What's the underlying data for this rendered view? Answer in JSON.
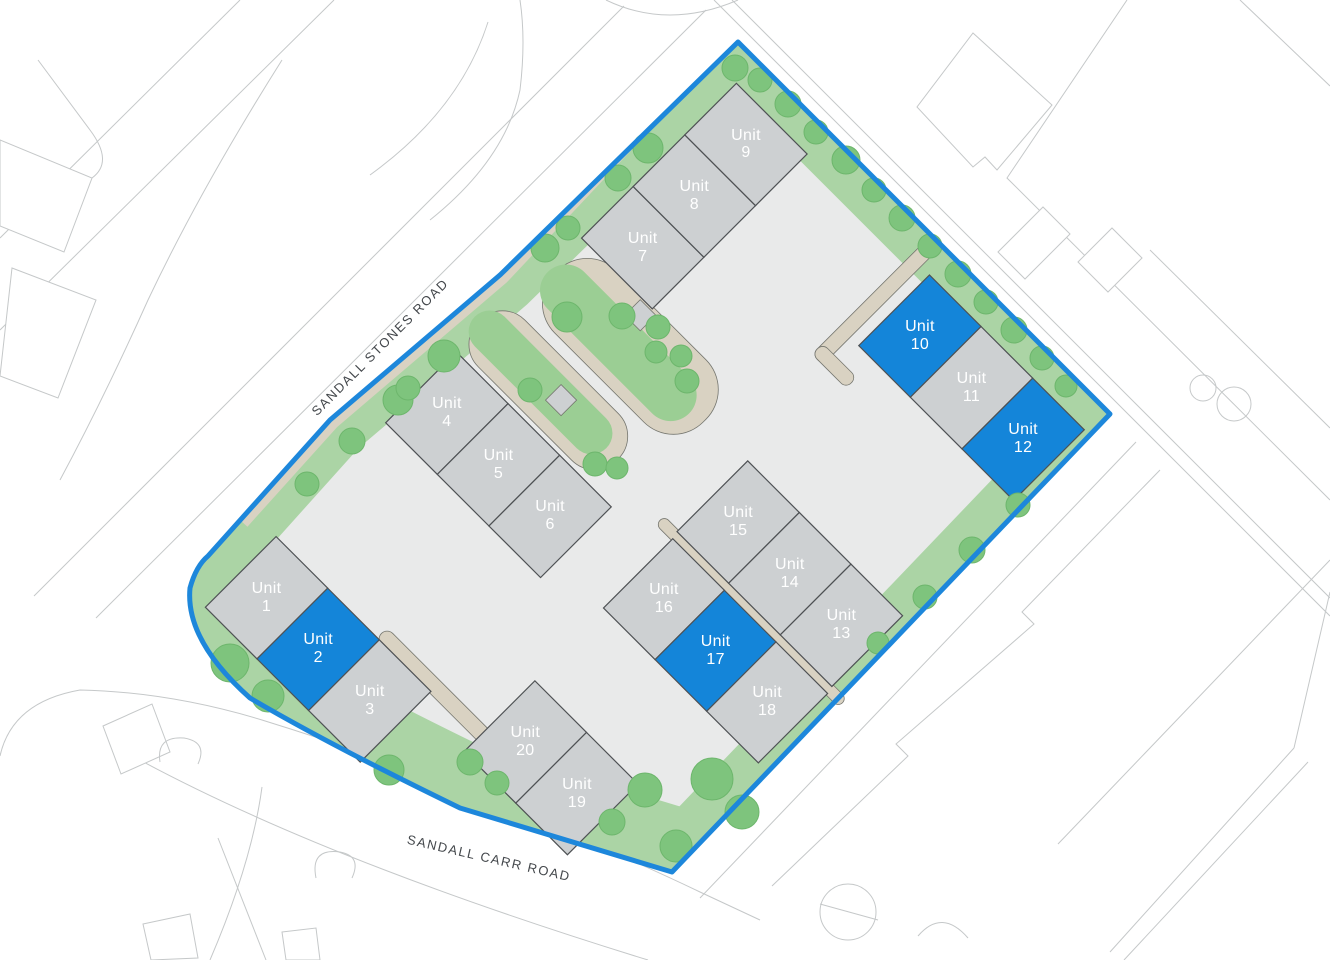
{
  "roads": {
    "sandall_stones": {
      "label": "SANDALL STONES ROAD"
    },
    "sandall_carr": {
      "label": "SANDALL CARR ROAD"
    }
  },
  "units": [
    {
      "number": "1",
      "label": "Unit",
      "highlighted": false
    },
    {
      "number": "2",
      "label": "Unit",
      "highlighted": true
    },
    {
      "number": "3",
      "label": "Unit",
      "highlighted": false
    },
    {
      "number": "4",
      "label": "Unit",
      "highlighted": false
    },
    {
      "number": "5",
      "label": "Unit",
      "highlighted": false
    },
    {
      "number": "6",
      "label": "Unit",
      "highlighted": false
    },
    {
      "number": "7",
      "label": "Unit",
      "highlighted": false
    },
    {
      "number": "8",
      "label": "Unit",
      "highlighted": false
    },
    {
      "number": "9",
      "label": "Unit",
      "highlighted": false
    },
    {
      "number": "10",
      "label": "Unit",
      "highlighted": true
    },
    {
      "number": "11",
      "label": "Unit",
      "highlighted": false
    },
    {
      "number": "12",
      "label": "Unit",
      "highlighted": true
    },
    {
      "number": "13",
      "label": "Unit",
      "highlighted": false
    },
    {
      "number": "14",
      "label": "Unit",
      "highlighted": false
    },
    {
      "number": "15",
      "label": "Unit",
      "highlighted": false
    },
    {
      "number": "16",
      "label": "Unit",
      "highlighted": false
    },
    {
      "number": "17",
      "label": "Unit",
      "highlighted": true
    },
    {
      "number": "18",
      "label": "Unit",
      "highlighted": false
    },
    {
      "number": "19",
      "label": "Unit",
      "highlighted": false
    },
    {
      "number": "20",
      "label": "Unit",
      "highlighted": false
    }
  ],
  "colors": {
    "highlighted_unit_blue": "#1485d9",
    "unit_grey": "#cdd0d2",
    "unit_outline": "#4e5154",
    "boundary_blue": "#1d87db",
    "landscape_green": "#abd4a5",
    "strip_green": "#9bce94",
    "tree_green": "#7ec47d",
    "tree_outline": "#6db66c",
    "path_beige": "#d9d2c2",
    "path_outline": "#75766f",
    "yard_grey": "#e9eaea",
    "context_line_grey": "#c5c8c9",
    "unit_label_text": "#ffffff",
    "road_label_text": "#43474b"
  }
}
